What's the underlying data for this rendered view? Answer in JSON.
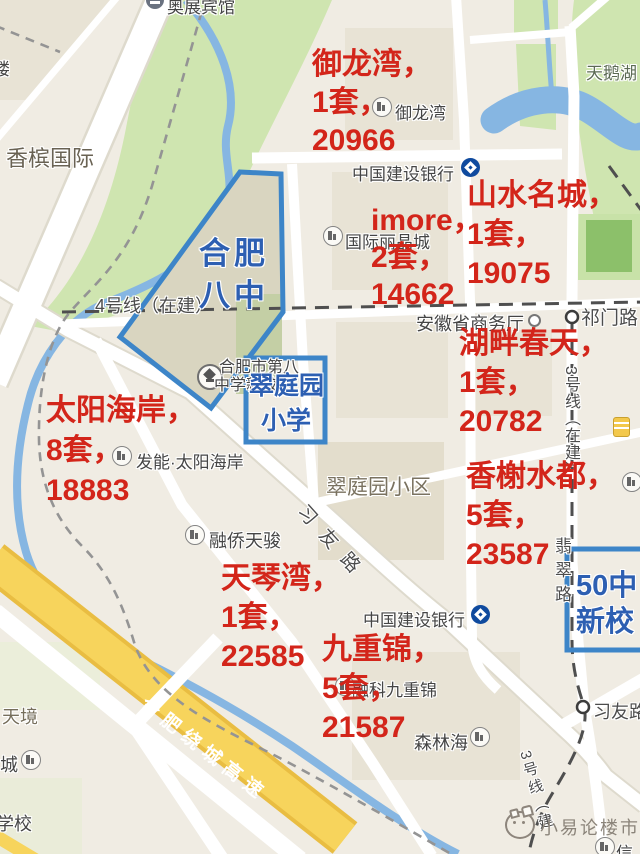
{
  "colors": {
    "annotation_red": "#d3251a",
    "school_blue_border": "#3d85c8",
    "school_blue_text": "#2d5fb2",
    "ccb_blue": "#0f4a9e",
    "highway_yellow": "#f7d45c"
  },
  "listings": [
    {
      "name": "御龙湾，",
      "units": "1套，",
      "price": "20966"
    },
    {
      "name": "imore，",
      "units": "2套，",
      "price": "14662"
    },
    {
      "name": "山水名城，",
      "units": "1套，",
      "price": "19075"
    },
    {
      "name": "湖畔春天，",
      "units": "1套，",
      "price": "20782"
    },
    {
      "name": "太阳海岸，",
      "units": "8套，",
      "price": "18883"
    },
    {
      "name": "香榭水都，",
      "units": "5套，",
      "price": "23587"
    },
    {
      "name": "天琴湾，",
      "units": "1套，",
      "price": "22585"
    },
    {
      "name": "九重锦，",
      "units": "5套，",
      "price": "21587"
    }
  ],
  "schools": {
    "hefei8_line1": "合肥",
    "hefei8_line2": "八中",
    "cuitingyuan_line1": "翠庭园",
    "cuitingyuan_line2": "小学",
    "no50_line1": "50中",
    "no50_line2": "新校"
  },
  "transit": {
    "line4": "4号线（在建）",
    "line3_east": "3号线（在建）",
    "line3_south": "3号线（建",
    "station_qimenlu": "祁门路",
    "station_xiyoulu": "习友路"
  },
  "roads": {
    "xiyou_road": "习友路",
    "feicui_road": "翡翠路",
    "ring_expressway": "合肥绕城高速"
  },
  "places": {
    "hotel_aozhan": "奥展宾馆",
    "lou_partial": "楼",
    "champagne_intl": "香槟国际",
    "swan_lake": "天鹅湖",
    "yulongwan": "御龙湾",
    "ccb": "中国建设银行",
    "intl_lijingcheng": "国际丽晶城",
    "commerce_dept": "安徽省商务厅",
    "hefei8_campus_line1": "合肥市第八",
    "hefei8_campus_line2": "中学新校区",
    "cuitingyuan_estate": "翠庭园小区",
    "faneng_sun_coast": "发能·太阳海岸",
    "rongqiao_tianjun": "融侨天骏",
    "rongke_jiuchongjin": "融科九重锦",
    "senlinhai": "森林海",
    "tianjing": "天境",
    "cheng_partial": "城",
    "xuexiao_partial": "学校",
    "xin_partial": "信"
  },
  "watermark": {
    "text": "小易论楼市"
  },
  "icons": {
    "building_poi": "building-in-circle",
    "bank": "ccb-logo-circle",
    "metro_station": "white-ring-circle",
    "hotel": "bed-in-dark-circle",
    "shop": "yellow-storefront",
    "school": "graduation-cap-circle",
    "watermark_logo": "cat-face-outline"
  }
}
